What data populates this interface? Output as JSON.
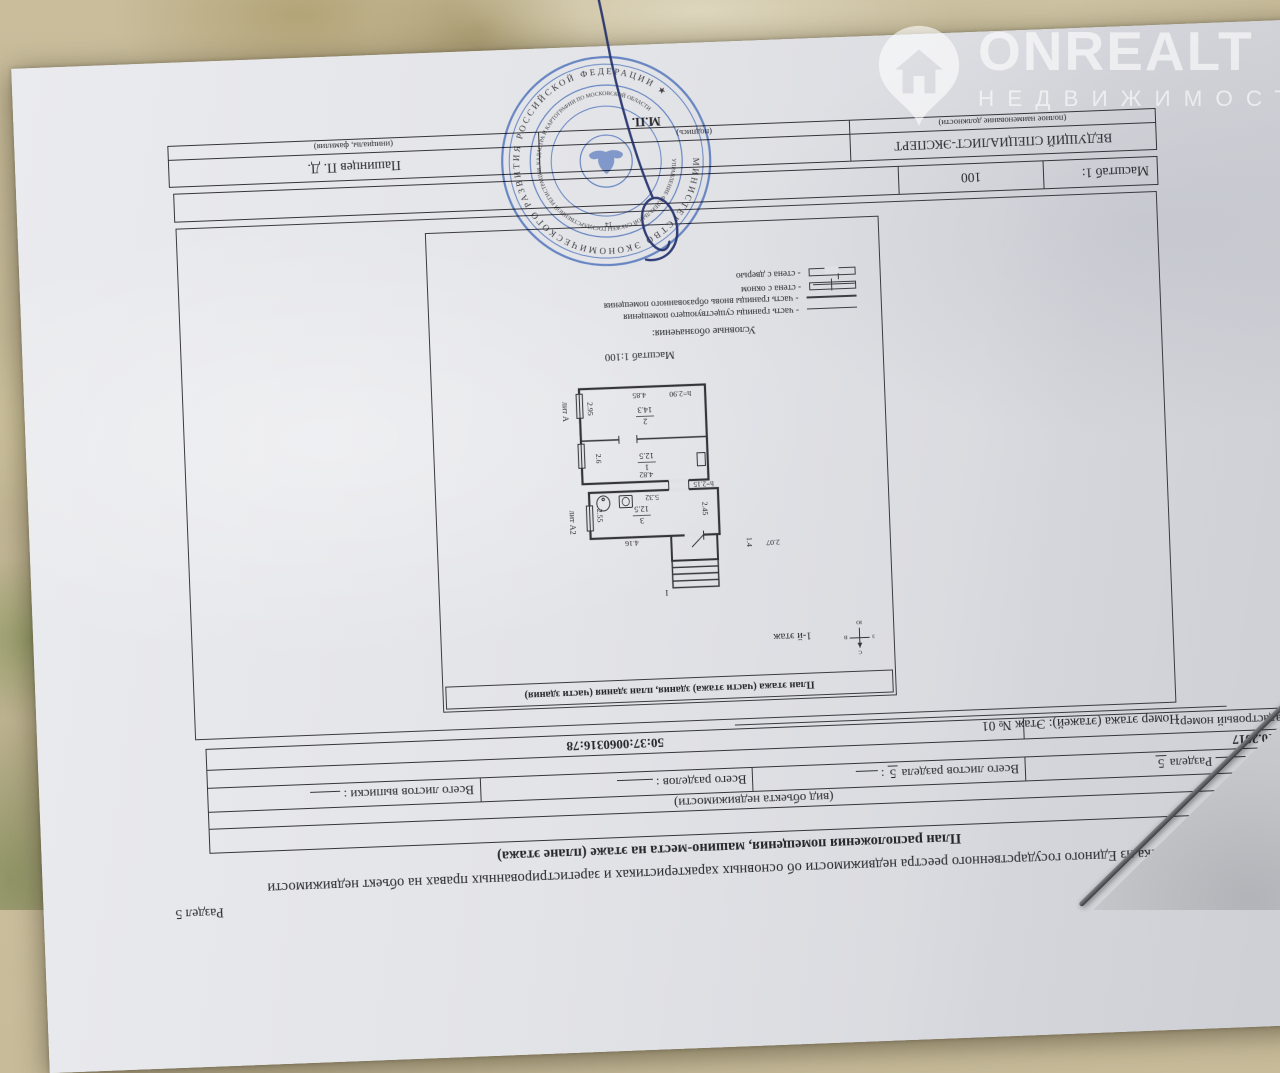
{
  "watermark": {
    "brand": "ONREALT",
    "tagline": "НЕДВИЖИМОСТЬ"
  },
  "doc": {
    "section": "Раздел 5",
    "title": "Выписка из Единого государственного реестра недвижимости об основных характеристиках и зарегистрированных правах на объект недвижимости",
    "subtitle": "План расположения помещения, машино-места на этаже (плане этажа)",
    "object_type": "Помещение",
    "object_type_caption": "(вид объекта недвижимости)",
    "sheet_label": "Лист №",
    "sheet_of": "Раздела",
    "sheet_section_num": "5",
    "sheets_total_label": "Всего листов раздела",
    "sheets_total_num": "5",
    "sheets_total_colon": ":",
    "sections_total_label": "Всего разделов :",
    "extract_sheets_label": "Всего листов выписки :",
    "date": "31.10.2017",
    "cadastral_label": "Кадастровый номер:",
    "cadastral_number": "50:37:0060316:78",
    "floor_line": "Номер этажа (этажей): Этаж № 01",
    "scale_label": "Масштаб 1:",
    "scale_value": "100"
  },
  "plan": {
    "frame_title": "План этажа (части этажа) здания, план здания (части здания)",
    "floor_note": "1-й этаж",
    "scale_note": "Масштаб 1:100",
    "legend_title": "Условные обозначения:",
    "legend": {
      "existing": "- часть границы существующего помещения",
      "new": "- часть границы вновь образованного помещения",
      "window": "- стена с окном",
      "door": "- стена с дверью"
    },
    "rooms": [
      {
        "num": "1",
        "area": "12.5"
      },
      {
        "num": "2",
        "area": "14.3"
      },
      {
        "num": "3",
        "area": "12.5"
      }
    ],
    "dims": {
      "room2_width": "4.85",
      "room2_height": "h=2.90",
      "room2_side": "2.95",
      "room1_width": "4.82",
      "room1_side": "2.6",
      "room3_bottom": "5.32",
      "room3_height": "h=2.15",
      "room3_right": "2.55",
      "room3_left": "2.45",
      "room3_top": "4.16",
      "porch_width": "2.07",
      "porch_depth": "1.4",
      "stair_label": "I",
      "lit_a": "лит А",
      "lit_a2": "лит А2"
    },
    "compass": {
      "n": "С",
      "s": "Ю",
      "w": "З",
      "e": "В"
    }
  },
  "signature": {
    "position": "ВЕДУЩИЙ СПЕЦИАЛИСТ-ЭКСПЕРТ",
    "position_caption": "(полное наименование должности)",
    "sign_caption": "(подпись)",
    "name": "Пашинцев П. Д.",
    "name_caption": "(инициалы, фамилия)",
    "mp": "М.П."
  },
  "stamp": {
    "outer_text": "МИНИСТЕРСТВО ЭКОНОМИЧЕСКОГО РАЗВИТИЯ РОССИЙСКОЙ ФЕДЕРАЦИИ ★",
    "inner_text": "УПРАВЛЕНИЕ ФЕДЕРАЛЬНОЙ СЛУЖБЫ ГОСУДАРСТВЕННОЙ РЕГИСТРАЦИИ, КАДАСТРА И КАРТОГРАФИИ ПО МОСКОВСКОЙ ОБЛАСТИ",
    "number": "14"
  },
  "colors": {
    "stamp_blue": "#5578bd",
    "ink_blue": "#22306b",
    "paper": "#e3e4e8"
  }
}
